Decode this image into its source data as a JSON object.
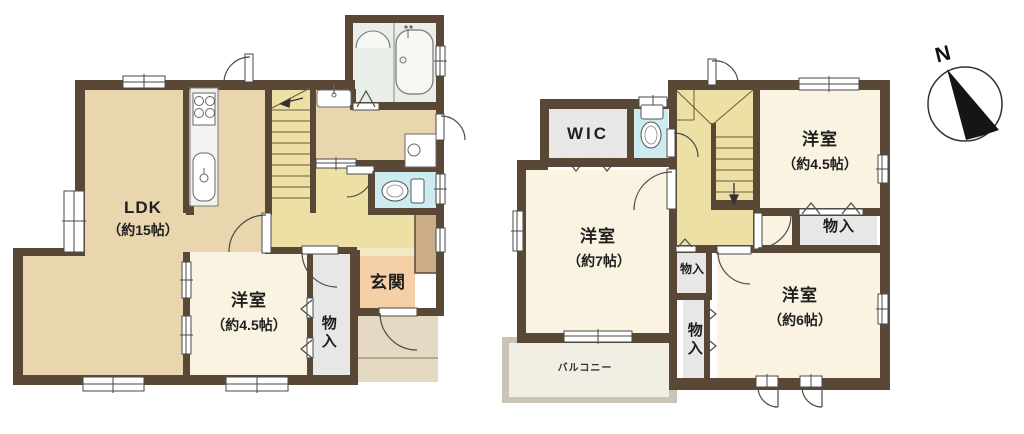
{
  "floor1": {
    "ldk": {
      "name": "LDK",
      "size": "（約15帖）"
    },
    "bedroom": {
      "name": "洋室",
      "size": "（約4.5帖）"
    },
    "closet": {
      "label": "物入"
    },
    "entrance": {
      "label": "玄関"
    }
  },
  "floor2": {
    "wic": {
      "label": "WIC"
    },
    "bedroom_45": {
      "name": "洋室",
      "size": "（約4.5帖）"
    },
    "closet_top": {
      "label": "物入"
    },
    "bedroom_7": {
      "name": "洋室",
      "size": "（約7帖）"
    },
    "closet_mid": {
      "label": "物入"
    },
    "closet_low": {
      "label": "物入"
    },
    "bedroom_6": {
      "name": "洋室",
      "size": "（約6帖）"
    },
    "balcony": {
      "label": "バルコニー"
    }
  },
  "compass": {
    "north": "N"
  },
  "colors": {
    "wall": "#594836",
    "room_tan": "#e9d6ae",
    "hall_yellow": "#ece0a4",
    "room_cream": "#faf3e2",
    "entrance_peach": "#f5cfa6",
    "closet_gray": "#e7e7e5",
    "toilet_blue": "#cdecf2",
    "bath_green": "#e9efe8",
    "porch": "#e6d9c4",
    "balcony_wall": "#c9c4b6",
    "cabinet_brown": "#cbae88"
  }
}
